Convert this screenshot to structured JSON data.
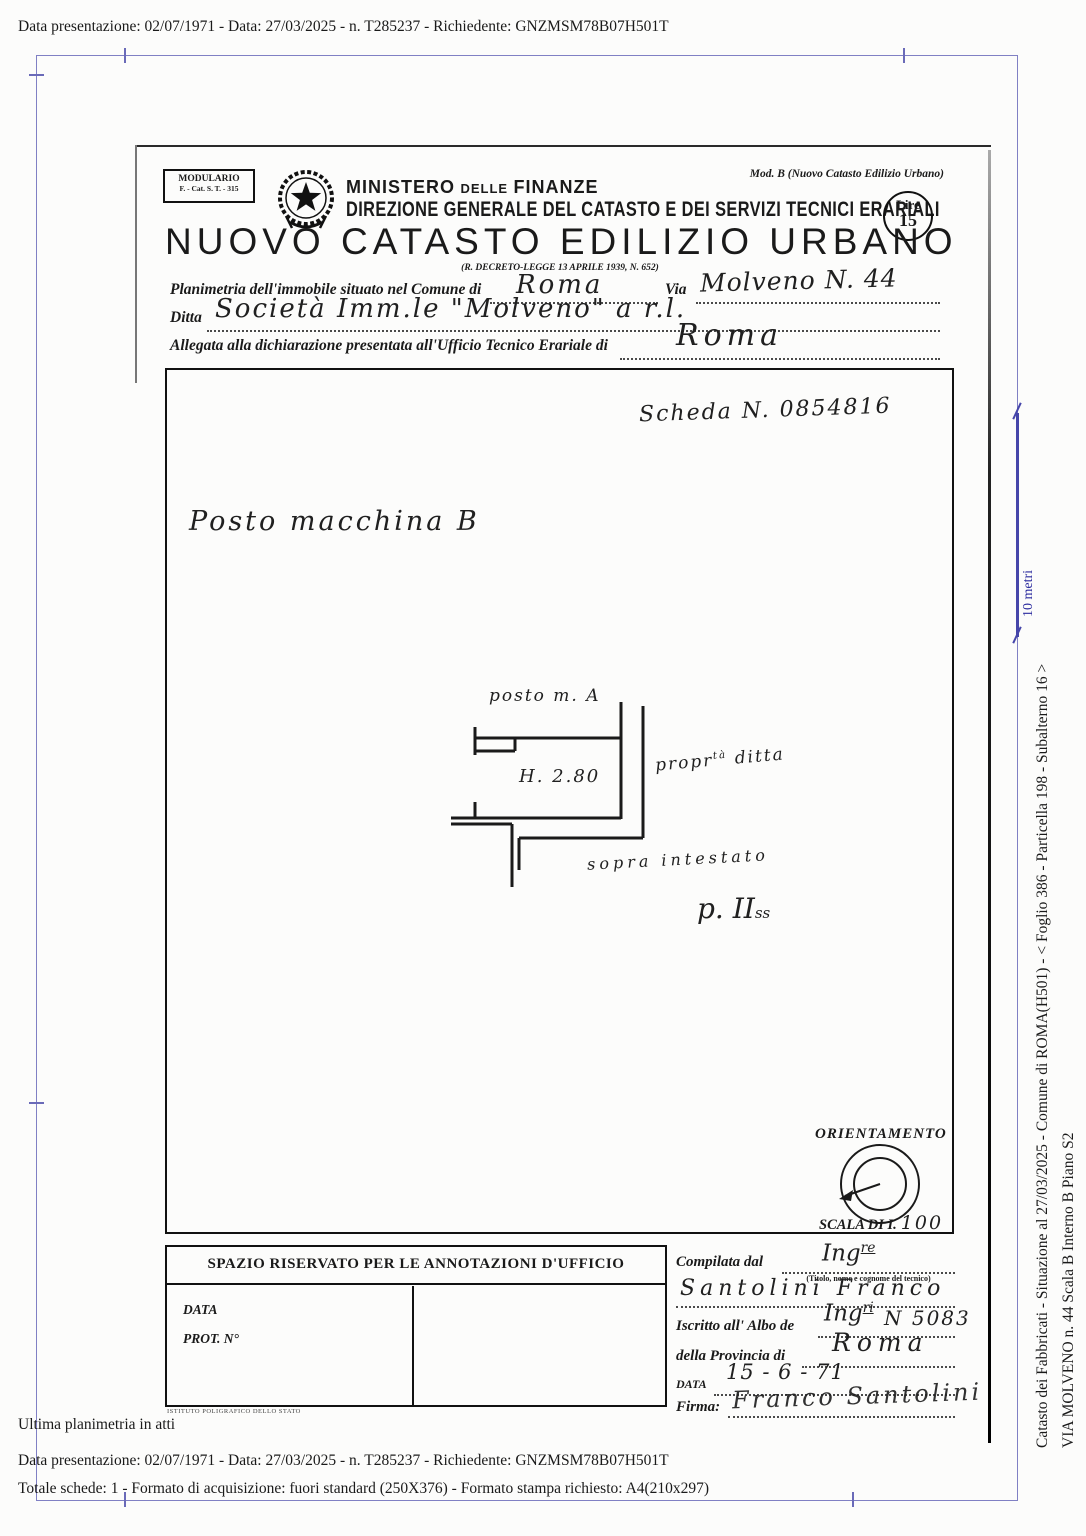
{
  "meta": {
    "top_line": "Data presentazione: 02/07/1971 - Data: 27/03/2025 - n. T285237 - Richiedente: GNZMSM78B07H501T",
    "ultima_note": "Ultima planimetria in atti",
    "bottom_line1": "Data presentazione: 02/07/1971 - Data: 27/03/2025 - n. T285237 - Richiedente: GNZMSM78B07H501T",
    "bottom_line2": "Totale schede: 1 - Formato di acquisizione: fuori standard (250X376) - Formato stampa richiesto: A4(210x297)"
  },
  "margin": {
    "scale_label": "10 metri",
    "side_line1": "Catasto dei Fabbricati - Situazione al 27/03/2025 - Comune di ROMA(H501) - < Foglio 386 - Particella 198 - Subalterno 16 >",
    "side_line2": "VIA MOLVENO n. 44  Scala B Interno B Piano S2"
  },
  "header": {
    "modulario_line1": "MODULARIO",
    "modulario_line2": "F. - Cat. S. T. - 315",
    "ministero": "MINISTERO",
    "delle": "DELLE",
    "finanze": "FINANZE",
    "direzione": "DIREZIONE GENERALE DEL CATASTO E DEI SERVIZI TECNICI ERARIALI",
    "mod_b": "Mod. B (Nuovo Catasto Edilizio Urbano)",
    "lire_label": "Lire",
    "lire_value": "15",
    "title": "NUOVO CATASTO EDILIZIO URBANO",
    "decree": "(R. DECRETO-LEGGE 13 APRILE 1939, N. 652)"
  },
  "form": {
    "field1_label": "Planimetria dell'immobile situato nel Comune di",
    "field1_value": "Roma",
    "via_label": "Via",
    "via_value": "Molveno N. 44",
    "ditta_label": "Ditta",
    "ditta_value": "Società Imm.le \"Molveno\"  a r.l.",
    "allegata_label": "Allegata alla dichiarazione presentata all'Ufficio Tecnico Erariale di",
    "allegata_value": "Roma"
  },
  "drawing": {
    "scheda": "Scheda N. 0854816",
    "title": "Posto macchina B",
    "label_posto_a": "posto m. A",
    "label_height": "H. 2.80",
    "label_prop": "propr",
    "label_prop_sup": "tà",
    "label_prop_rest": " ditta",
    "label_sopra": "sopra intestato",
    "label_piano": "p. II",
    "label_piano_sup": "ss",
    "orientamento": "ORIENTAMENTO",
    "scala_label": "SCALA DI I.",
    "scala_value": "100"
  },
  "annotations": {
    "title": "SPAZIO RISERVATO PER LE ANNOTAZIONI D'UFFICIO",
    "data_label": "DATA",
    "prot_label": "PROT. N°",
    "printer": "ISTITUTO POLIGRAFICO DELLO STATO"
  },
  "compiler": {
    "compilata_label": "Compilata dal",
    "compilata_value": "Ing",
    "compilata_sup": "re",
    "hint": "(Titolo, nome e cognome del tecnico)",
    "name_value": "Santolini Franco",
    "albo_label": "Iscritto all' Albo de",
    "albo_value": "Ing",
    "albo_sup": "ri",
    "albo_number": "N 5083",
    "provincia_label": "della Provincia di",
    "provincia_value": "Roma",
    "data_label": "DATA",
    "data_value": "15 - 6 - 71",
    "firma_label": "Firma:",
    "firma_value": "Franco Santolini"
  }
}
